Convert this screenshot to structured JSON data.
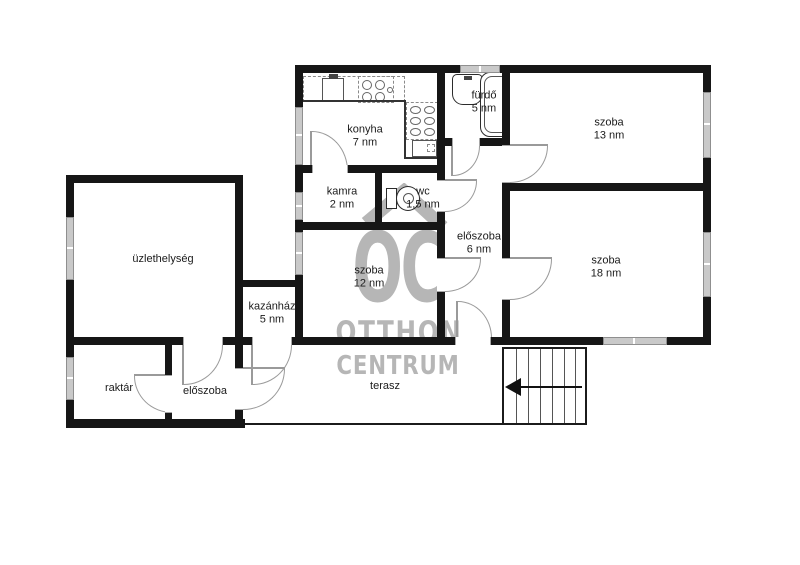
{
  "watermark": {
    "initials": "OC",
    "line1": "OTTHON",
    "line2": "CENTRUM"
  },
  "rooms": {
    "konyha": {
      "label": "konyha",
      "area": "7 nm"
    },
    "kamra": {
      "label": "kamra",
      "area": "2 nm"
    },
    "wc": {
      "label": "wc",
      "area": "1,5 nm"
    },
    "furdo": {
      "label": "fürdő",
      "area": "5 nm"
    },
    "szoba13": {
      "label": "szoba",
      "area": "13 nm"
    },
    "szoba18": {
      "label": "szoba",
      "area": "18 nm"
    },
    "szoba12": {
      "label": "szoba",
      "area": "12 nm"
    },
    "eloszoba": {
      "label": "előszoba",
      "area": "6 nm"
    },
    "uzlethelyseg": {
      "label": "üzlethelység"
    },
    "kazanhaz": {
      "label": "kazánház",
      "area": "5 nm"
    },
    "raktar": {
      "label": "raktár"
    },
    "eloszoba_kis": {
      "label": "előszoba"
    },
    "terasz": {
      "label": "terasz"
    }
  }
}
